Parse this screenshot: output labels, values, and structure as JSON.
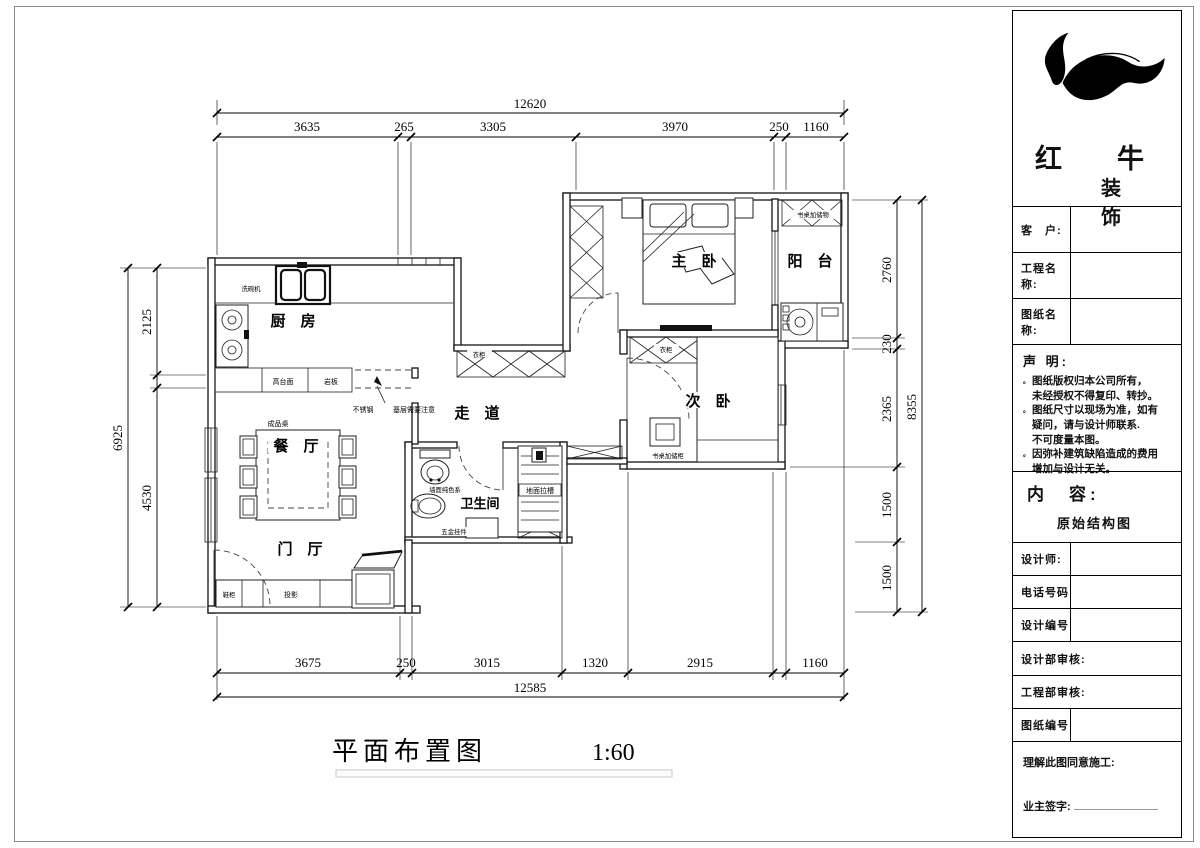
{
  "drawing_title": {
    "name": "平面布置图",
    "scale": "1:60"
  },
  "dimensions": {
    "top": {
      "total": "12620",
      "segments": [
        "3635",
        "265",
        "3305",
        "3970",
        "250",
        "1160"
      ]
    },
    "bottom": {
      "total": "12585",
      "segments": [
        "3675",
        "250",
        "3015",
        "1320",
        "2915",
        "1160"
      ]
    },
    "left": {
      "total": "6925",
      "segments": [
        "2125",
        "4530"
      ]
    },
    "right": {
      "total": "8355",
      "segments": [
        "2760",
        "230",
        "2365",
        "1500",
        "1500"
      ]
    }
  },
  "rooms": {
    "kitchen": "厨　房",
    "dining": "餐　厅",
    "entry": "门　厅",
    "corridor": "走　道",
    "master": "主　卧",
    "balcony": "阳　台",
    "second": "次　卧",
    "bath": "卫生间"
  },
  "annotations": {
    "dishwasher": "洗碗机",
    "high_counter": "高台面",
    "slab": "岩板",
    "stainless": "不锈钢",
    "base_note": "基层需要注意",
    "ready_table": "成品桌",
    "shoe_cabinet": "鞋柜",
    "projector": "投影",
    "wardrobe_hall": "衣柜",
    "wardrobe_second": "衣柜",
    "desk_storage_balcony": "书桌加储物",
    "desk_storage_second": "书桌加储柜",
    "wall_finish": "墙面纯色系",
    "floor_groove": "地面拉槽",
    "hardware": "五金挂件"
  },
  "title_block": {
    "brand": {
      "line1": "红　牛",
      "line2": "装　饰"
    },
    "fields": {
      "customer": "客　户:",
      "project": "工程名称:",
      "drawing": "图纸名称:",
      "designer": "设计师:",
      "phone": "电话号码",
      "design_no": "设计编号",
      "design_review": "设计部审核:",
      "engineering_review": "工程部审核:",
      "drawing_no": "图纸编号"
    },
    "statement": {
      "title": "声 明:",
      "marker": "。",
      "items": [
        "图纸版权归本公司所有，\n未经授权不得复印、转抄。",
        "图纸尺寸以现场为准，如有\n疑问，请与设计师联系.\n不可度量本图。",
        "因弥补建筑缺陷造成的费用\n增加与设计无关。"
      ]
    },
    "content": {
      "label": "内　容:",
      "value": "原始结构图"
    },
    "footer": {
      "agree": "理解此图同意施工:",
      "sign": "业主签字:"
    }
  }
}
